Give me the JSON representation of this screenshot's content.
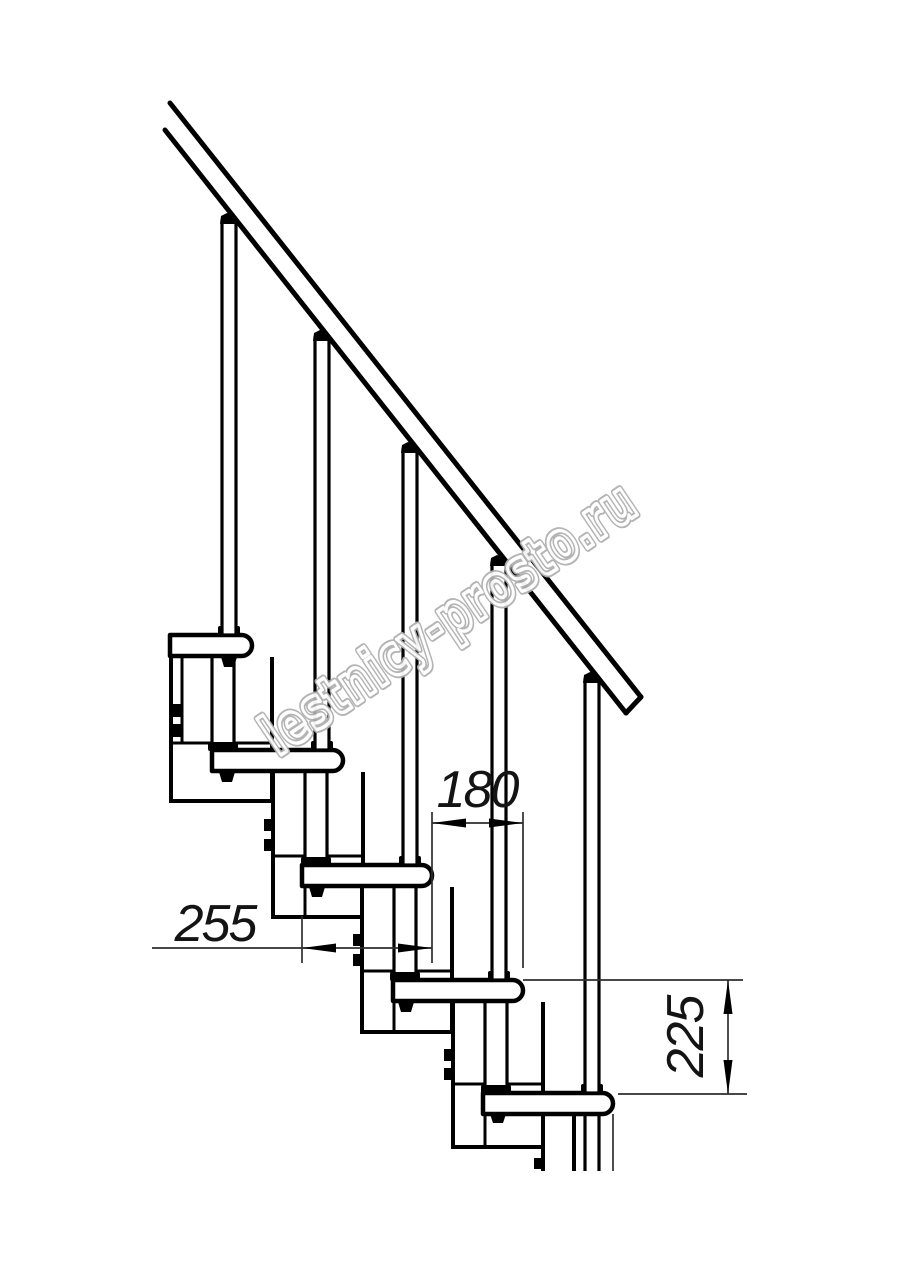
{
  "drawing_title": "modular-staircase-side-view",
  "watermark": {
    "text": "lestnicy-prosto.ru"
  },
  "dimensions": {
    "tread_depth": {
      "label": "255",
      "orientation": "horizontal"
    },
    "step_offset": {
      "label": "180",
      "orientation": "horizontal"
    },
    "riser_height": {
      "label": "225",
      "orientation": "vertical"
    }
  },
  "colors": {
    "background": "#ffffff",
    "line": "#000000",
    "dimension_line": "#2e2e2e",
    "dimension_text": "#141414",
    "watermark_outline": "#b0b0b0",
    "watermark_inner": "#ffffff"
  }
}
